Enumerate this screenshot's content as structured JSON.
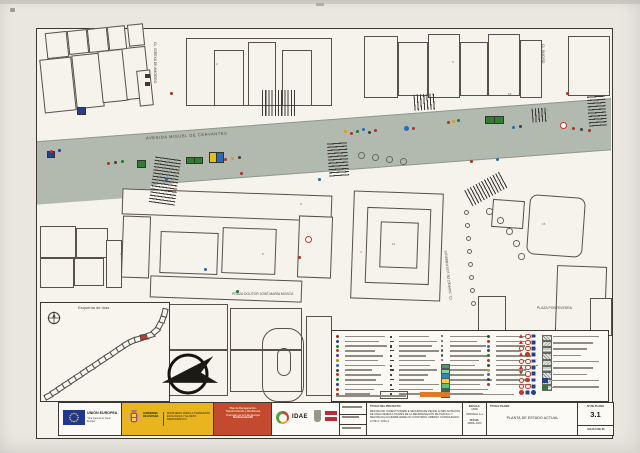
{
  "sheet": {
    "paper_color": "#eae7e0",
    "drawing_bg": "#f5f3ec",
    "road_color": "#b2bab0",
    "frame_color": "#3b3831"
  },
  "plan": {
    "street_labels": {
      "avenue": "AVENIDA MIGUEL DE CERVANTES",
      "igrexa": "CL. IGREXA DE AMOEIRO",
      "bucino": "CL. BUCIÑO",
      "suarez": "CL. SUÁREZ DE LOS RIBEROS",
      "praza": "PRAZA DOUTOR JOSÉ MARÍA MOSCA",
      "pontevedra": "PLAZA PONTEVEDRA"
    },
    "buildings": [
      [
        42,
        58,
        30,
        52,
        -6
      ],
      [
        74,
        54,
        26,
        52,
        -6
      ],
      [
        100,
        50,
        24,
        50,
        -6
      ],
      [
        124,
        47,
        22,
        50,
        -6
      ],
      [
        46,
        32,
        20,
        24,
        -6
      ],
      [
        68,
        30,
        18,
        22,
        -6
      ],
      [
        88,
        28,
        18,
        22,
        -6
      ],
      [
        108,
        26,
        16,
        22,
        -6
      ],
      [
        128,
        24,
        14,
        20,
        -6
      ],
      [
        138,
        70,
        12,
        34,
        -6
      ],
      [
        186,
        38,
        144,
        66,
        0
      ],
      [
        214,
        50,
        28,
        54,
        0
      ],
      [
        248,
        42,
        26,
        62,
        0
      ],
      [
        282,
        50,
        28,
        54,
        0
      ],
      [
        364,
        36,
        32,
        60,
        0
      ],
      [
        398,
        42,
        28,
        52,
        0
      ],
      [
        428,
        34,
        30,
        62,
        0
      ],
      [
        460,
        42,
        26,
        52,
        0
      ],
      [
        488,
        34,
        30,
        60,
        0
      ],
      [
        520,
        40,
        20,
        56,
        0
      ],
      [
        568,
        36,
        40,
        58,
        0
      ],
      [
        122,
        192,
        208,
        24,
        2
      ],
      [
        122,
        216,
        26,
        60,
        2
      ],
      [
        298,
        216,
        32,
        60,
        2
      ],
      [
        160,
        232,
        56,
        40,
        2
      ],
      [
        222,
        228,
        52,
        44,
        2
      ],
      [
        150,
        278,
        150,
        20,
        2
      ],
      [
        40,
        226,
        34,
        30,
        0
      ],
      [
        76,
        228,
        30,
        28,
        0
      ],
      [
        40,
        258,
        32,
        28,
        0
      ],
      [
        74,
        258,
        28,
        26,
        0
      ],
      [
        106,
        240,
        14,
        46,
        0
      ],
      [
        352,
        192,
        88,
        106,
        2
      ],
      [
        366,
        208,
        62,
        74,
        2
      ],
      [
        380,
        222,
        36,
        44,
        2
      ],
      [
        492,
        200,
        30,
        26,
        4
      ],
      [
        478,
        296,
        26,
        38,
        0
      ],
      [
        556,
        266,
        48,
        64,
        2
      ],
      [
        590,
        298,
        20,
        36,
        0
      ],
      [
        164,
        304,
        62,
        44,
        0
      ],
      [
        164,
        350,
        62,
        44,
        0
      ],
      [
        230,
        308,
        70,
        40,
        0
      ],
      [
        230,
        350,
        70,
        40,
        0
      ],
      [
        306,
        316,
        24,
        78,
        0
      ]
    ],
    "round_building": [
      528,
      196,
      54,
      58,
      4
    ],
    "pills": [
      {
        "x": 262,
        "y": 328,
        "w": 40,
        "h": 72,
        "rad": 16
      },
      {
        "x": 277,
        "y": 348,
        "w": 12,
        "h": 26,
        "rad": 8
      }
    ],
    "zebras": [
      [
        262,
        90,
        34,
        26,
        0,
        90
      ],
      [
        152,
        158,
        26,
        46,
        8,
        0
      ],
      [
        328,
        142,
        20,
        34,
        -4,
        0
      ],
      [
        414,
        94,
        22,
        16,
        -4,
        90
      ],
      [
        532,
        108,
        16,
        14,
        -4,
        90
      ],
      [
        588,
        96,
        18,
        30,
        -4,
        0
      ],
      [
        466,
        180,
        40,
        18,
        -28,
        90
      ]
    ],
    "markers": [
      [
        137,
        160,
        7,
        6,
        "#2e7d32"
      ],
      [
        186,
        157,
        7,
        5,
        "#2e7d32"
      ],
      [
        194,
        157,
        7,
        5,
        "#2e7d32"
      ],
      [
        209,
        152,
        6,
        9,
        "#e2c219"
      ],
      [
        216,
        152,
        6,
        9,
        "#2b6cb8"
      ],
      [
        485,
        116,
        8,
        6,
        "#2e7d32"
      ],
      [
        494,
        116,
        8,
        6,
        "#2e7d32"
      ],
      [
        77,
        107,
        7,
        6,
        "#27408b"
      ],
      [
        47,
        151,
        6,
        5,
        "#27408b"
      ]
    ],
    "dots": [
      [
        50,
        150,
        "#b03428"
      ],
      [
        58,
        149,
        "#27408b"
      ],
      [
        107,
        162,
        "#b03428"
      ],
      [
        114,
        161,
        "#444444"
      ],
      [
        121,
        160,
        "#1e7d32"
      ],
      [
        224,
        158,
        "#b03428"
      ],
      [
        231,
        157,
        "#d4a017"
      ],
      [
        238,
        156,
        "#444444"
      ],
      [
        344,
        130,
        "#d4a017"
      ],
      [
        350,
        132,
        "#b03428"
      ],
      [
        356,
        130,
        "#1e7d32"
      ],
      [
        362,
        128,
        "#2b6cb8"
      ],
      [
        368,
        131,
        "#444444"
      ],
      [
        374,
        129,
        "#b03428"
      ],
      [
        412,
        127,
        "#b03428"
      ],
      [
        447,
        121,
        "#b03428"
      ],
      [
        452,
        120,
        "#d4a017"
      ],
      [
        457,
        119,
        "#1e7d32"
      ],
      [
        512,
        126,
        "#2b6cb8"
      ],
      [
        519,
        125,
        "#444444"
      ],
      [
        572,
        127,
        "#b03428"
      ],
      [
        580,
        128,
        "#444444"
      ],
      [
        588,
        129,
        "#b03428"
      ],
      [
        165,
        178,
        "#2b6cb8"
      ],
      [
        240,
        172,
        "#b03428"
      ],
      [
        318,
        178,
        "#2b6cb8"
      ],
      [
        470,
        160,
        "#b03428"
      ],
      [
        496,
        158,
        "#2b6cb8"
      ],
      [
        298,
        256,
        "#b03428"
      ],
      [
        204,
        268,
        "#2b6cb8"
      ],
      [
        236,
        290,
        "#1e7d32"
      ],
      [
        170,
        92,
        "#b03428"
      ],
      [
        566,
        92,
        "#b03428"
      ]
    ],
    "big_dot": [
      404,
      126,
      "#2b6cb8"
    ],
    "rings": [
      [
        560,
        122
      ],
      [
        305,
        236
      ]
    ],
    "trees": [
      [
        358,
        152
      ],
      [
        372,
        154
      ],
      [
        386,
        156
      ],
      [
        400,
        158
      ],
      [
        486,
        208
      ],
      [
        497,
        217
      ],
      [
        506,
        228
      ],
      [
        513,
        240
      ],
      [
        518,
        253
      ]
    ],
    "bollards": [
      [
        464,
        210
      ],
      [
        465,
        223
      ],
      [
        466,
        236
      ],
      [
        467,
        249
      ],
      [
        468,
        262
      ],
      [
        469,
        275
      ],
      [
        470,
        288
      ],
      [
        471,
        301
      ]
    ],
    "dark_squares": [
      [
        145,
        74
      ],
      [
        145,
        82
      ]
    ],
    "numbers": [
      [
        "2",
        216,
        62
      ],
      [
        "5",
        452,
        60
      ],
      [
        "3",
        120,
        252
      ],
      [
        "8",
        262,
        252
      ],
      [
        "12",
        392,
        242
      ],
      [
        "15",
        542,
        222
      ],
      [
        "7",
        80,
        302
      ],
      [
        "9",
        300,
        202
      ],
      [
        "18",
        508,
        92
      ],
      [
        "4",
        360,
        250
      ]
    ]
  },
  "esquema": {
    "title": "Esquema de rúas",
    "route": [
      [
        44,
        393,
        -28
      ],
      [
        50,
        389,
        -30
      ],
      [
        56,
        385,
        -32
      ],
      [
        62,
        381,
        -30
      ],
      [
        68,
        377,
        -33
      ],
      [
        74,
        373,
        -31
      ],
      [
        80,
        369,
        -33
      ],
      [
        86,
        365,
        -30
      ],
      [
        92,
        361,
        -34
      ],
      [
        98,
        357,
        -32
      ],
      [
        104,
        353,
        -30
      ],
      [
        110,
        349,
        -34
      ],
      [
        116,
        345,
        -32
      ],
      [
        122,
        341,
        -30
      ],
      [
        128,
        338,
        -25
      ],
      [
        134,
        336,
        -18
      ],
      [
        140,
        334,
        -10
      ],
      [
        146,
        332,
        -16
      ],
      [
        151,
        328,
        -40
      ],
      [
        155,
        322,
        -62
      ],
      [
        158,
        316,
        -72
      ],
      [
        160,
        310,
        -78
      ]
    ],
    "route_highlight_index": 16,
    "route_highlight_color": "#c0392b"
  },
  "legend": {
    "row_count": 13,
    "col_x": [
      336,
      390,
      441,
      487
    ],
    "bar_widths": [
      40,
      34,
      42,
      30,
      38,
      33,
      40,
      27,
      36,
      31,
      38,
      29,
      25
    ],
    "icon_colors_col1": [
      "#8a3324",
      "#27408b",
      "#1e7d32",
      "#b03428",
      "#6c3483",
      "#b8860b",
      "#2b6cb8",
      "#444444",
      "#b03428",
      "#1e7d32",
      "#27408b",
      "#b03428",
      "#8a3324"
    ],
    "icon_colors_col4": [
      "#444444",
      "#b03428",
      "#2b6cb8",
      "#444444",
      "#1e7d32",
      "#b03428",
      "#444444",
      "#d4a017",
      "#2b6cb8",
      "#444444",
      "#b03428"
    ],
    "swatch_colors": [
      "#3aa655",
      "#7fd49a",
      "#2e86c1",
      "#f2d02e",
      "#58c27a",
      "#117a5e",
      "#bfe3f0"
    ],
    "signs_grid": [
      "tcs",
      "tcs",
      "ccs",
      "tfs",
      "ccs",
      "tcs",
      "vcs",
      "cfs",
      "ccs",
      "fsb"
    ],
    "hatch_count": 9,
    "note_color": "#e0782a",
    "bottom_swatches": [
      "#27408b",
      "#2e7d32"
    ]
  },
  "titleblock": {
    "eu_title": "UNIÓN EUROPEA",
    "eu_sub": "\"Una manera de hacer Europa\"",
    "gob1": "GOBIERNO",
    "gob2": "DE ESPAÑA",
    "ministerio": "MINISTERIO PARA LA TRANSICIÓN ECOLÓGICA Y EL RETO DEMOGRÁFICO",
    "prtr1": "Plan de Recuperación,",
    "prtr2": "Transformación y Resiliencia",
    "prtr3": "Financiado por la Unión Europea",
    "prtr4": "NextGenerationEU",
    "idae": "IDAE",
    "proj_header": "TÍTULO DEL PROYECTO:",
    "proj_lines": [
      "MEJORA DE CONECTIVIDADE E SEGURIDADE PEONIL E IMPLANTACIÓN",
      "DE UNHA SENDA A TRAVÉS DE LA REORDENACIÓN DE TRÁFICO Y",
      "MEJORA DA ACCESIBILIDADE NO CONTORNO URBANO CONSOLIDADO.",
      "LOTE 2 / LIÑA 3"
    ],
    "escala_label": "ESCALA:",
    "escala_value": "1/500",
    "original": "ORIGINAL A-1",
    "fecha_label": "FECHA:",
    "fecha_value": "ABRIL 2023",
    "titulo_plano_label": "TÍTULO PLANO:",
    "titulo_plano": "PLANTA DE ESTADO ACTUAL",
    "num_label": "Nº DE PLANO",
    "num_value": "3.1",
    "hoja": "HOJA 6 DE 26"
  }
}
